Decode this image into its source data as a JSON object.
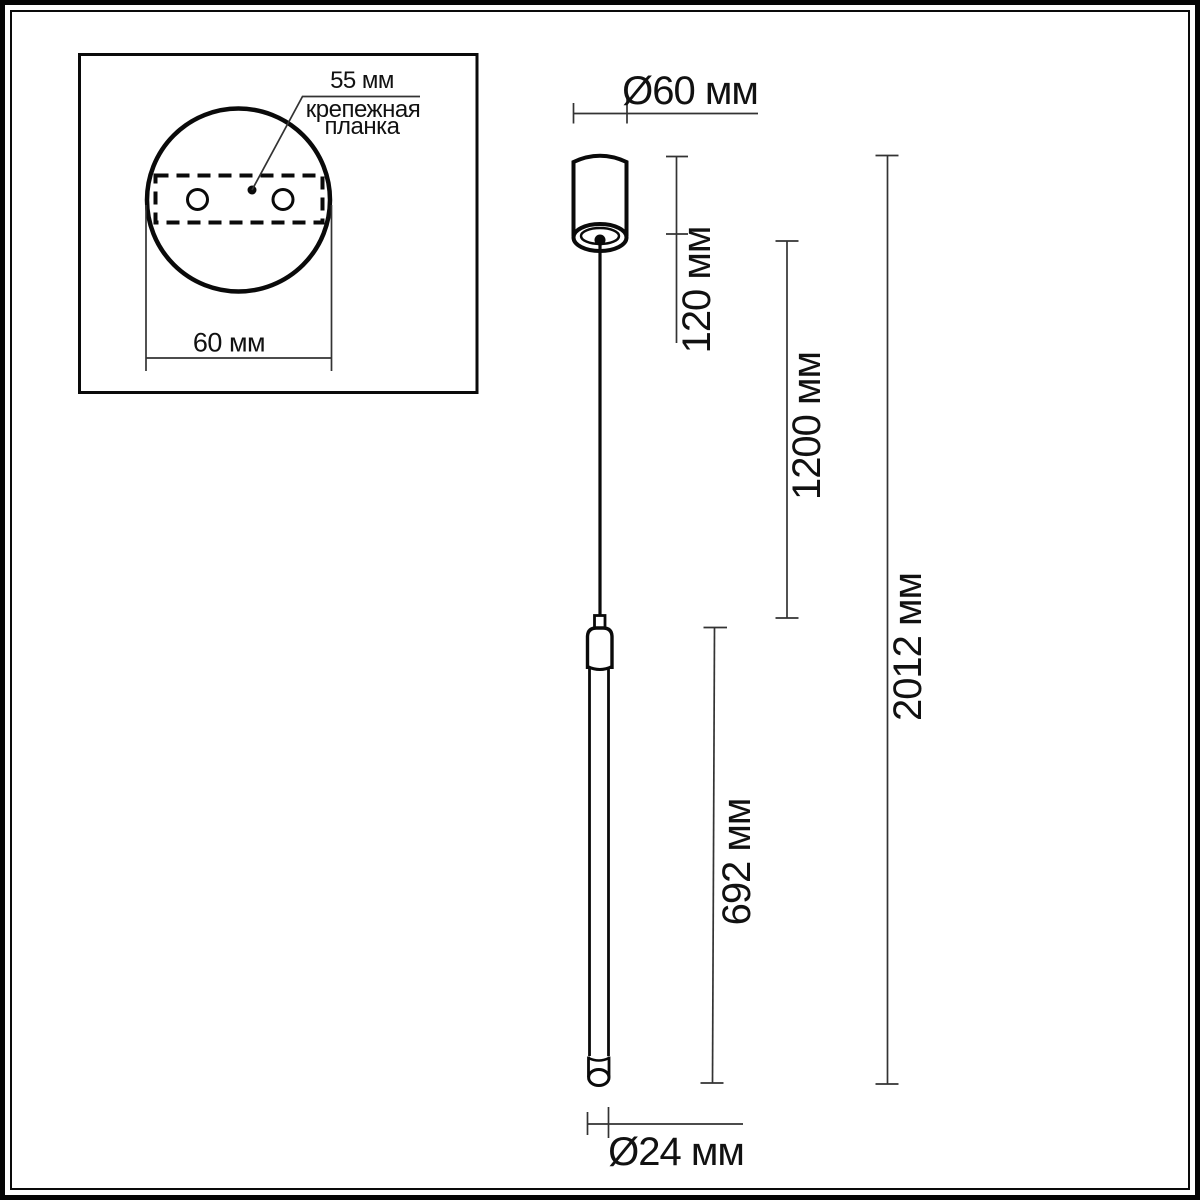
{
  "inset": {
    "offset_label": "55 мм",
    "part_name_line1": "крепежная",
    "part_name_line2": "планка",
    "width_label": "60 мм"
  },
  "dimensions": {
    "canopy_diameter": "Ø60 мм",
    "canopy_height": "120 мм",
    "suspension_length": "1200 мм",
    "total_height": "2012 мм",
    "tube_length": "692 мм",
    "tube_diameter": "Ø24 мм"
  },
  "colors": {
    "ink": "#000000",
    "dim_line": "#333333",
    "background": "#ffffff"
  }
}
